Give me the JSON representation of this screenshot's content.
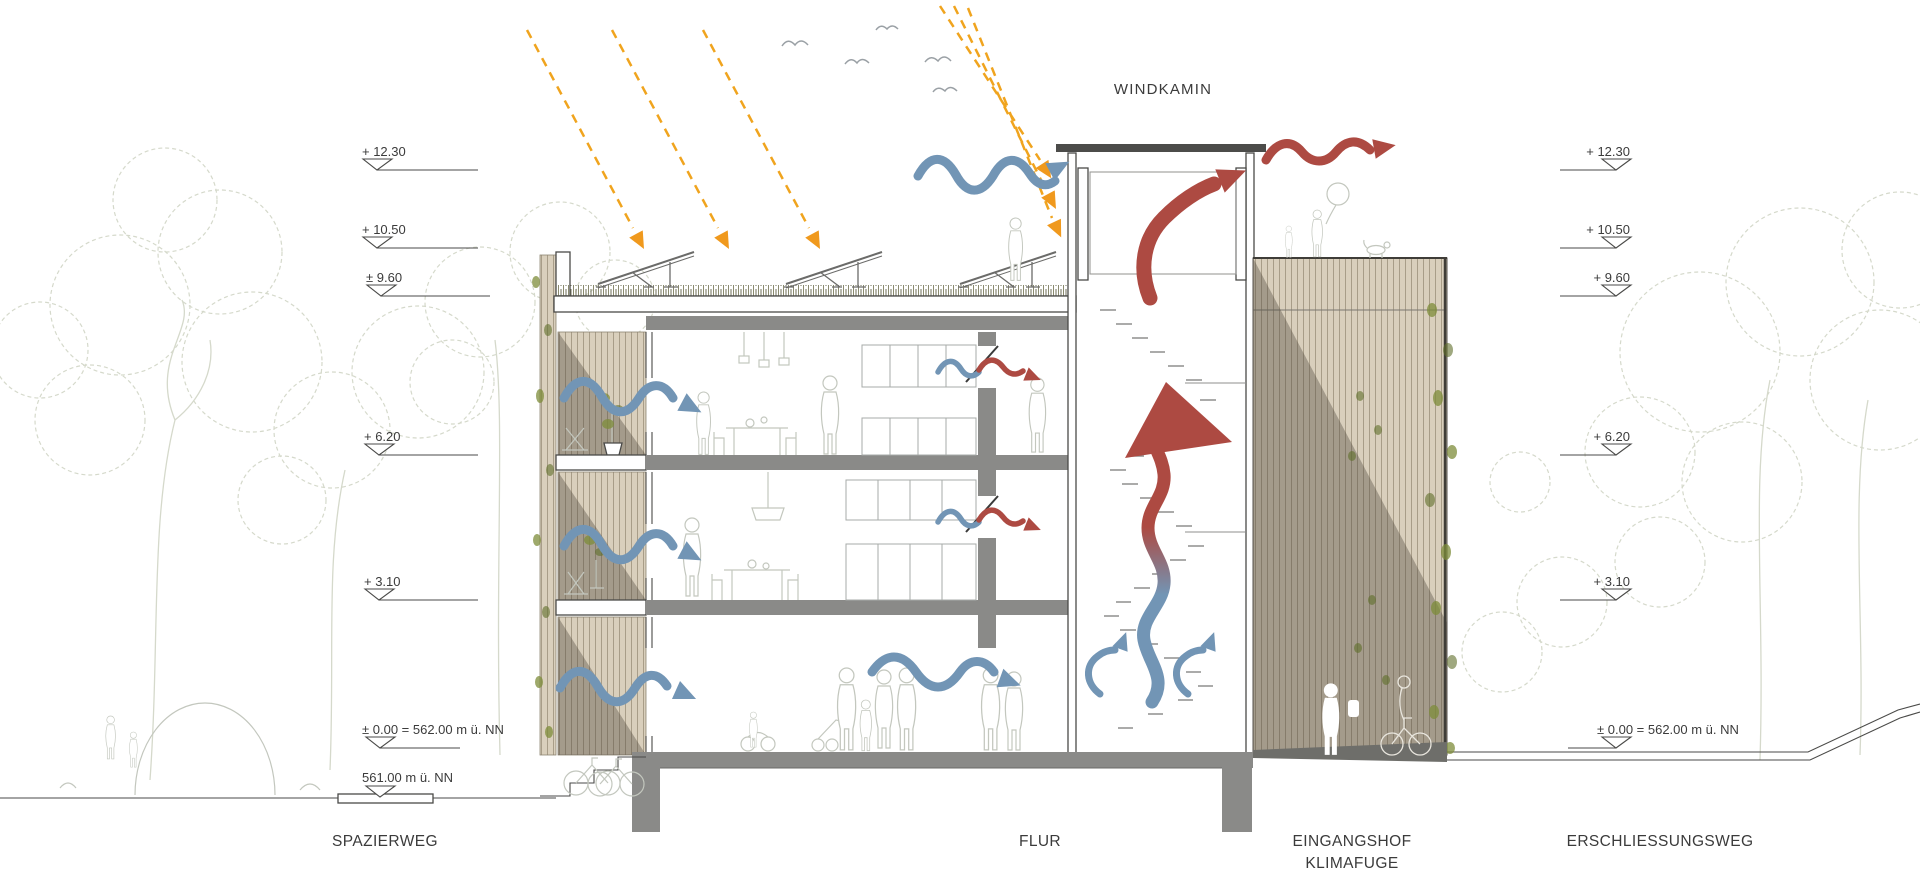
{
  "title": "WINDKAMIN",
  "levels": {
    "left": [
      {
        "label": "+ 12.30"
      },
      {
        "label": "+ 10.50"
      },
      {
        "label": "± 9.60"
      },
      {
        "label": "+ 6.20"
      },
      {
        "label": "+ 3.10"
      },
      {
        "label": "± 0.00 = 562.00 m ü. NN"
      },
      {
        "label": "561.00 m ü. NN"
      }
    ],
    "right": [
      {
        "label": "+ 12.30"
      },
      {
        "label": "+ 10.50"
      },
      {
        "label": "+ 9.60"
      },
      {
        "label": "+ 6.20"
      },
      {
        "label": "+ 3.10"
      },
      {
        "label": "± 0.00 = 562.00 m ü. NN"
      }
    ]
  },
  "zones": {
    "spazierweg": "SPAZIERWEG",
    "flur": "FLUR",
    "eingangshof": "EINGANGSHOF",
    "klimafuge": "KLIMAFUGE",
    "erschliessungsweg": "ERSCHLIESSUNGSWEG"
  },
  "legend_colors": {
    "warm_air": "#ad4a42",
    "cool_air": "#7295b5",
    "sunlight": "#f0a41e",
    "structure": "#8a8a88",
    "wood_facade": "#d9cfbc",
    "vegetation": "#7d8c3a",
    "text": "#3b3b3b"
  }
}
